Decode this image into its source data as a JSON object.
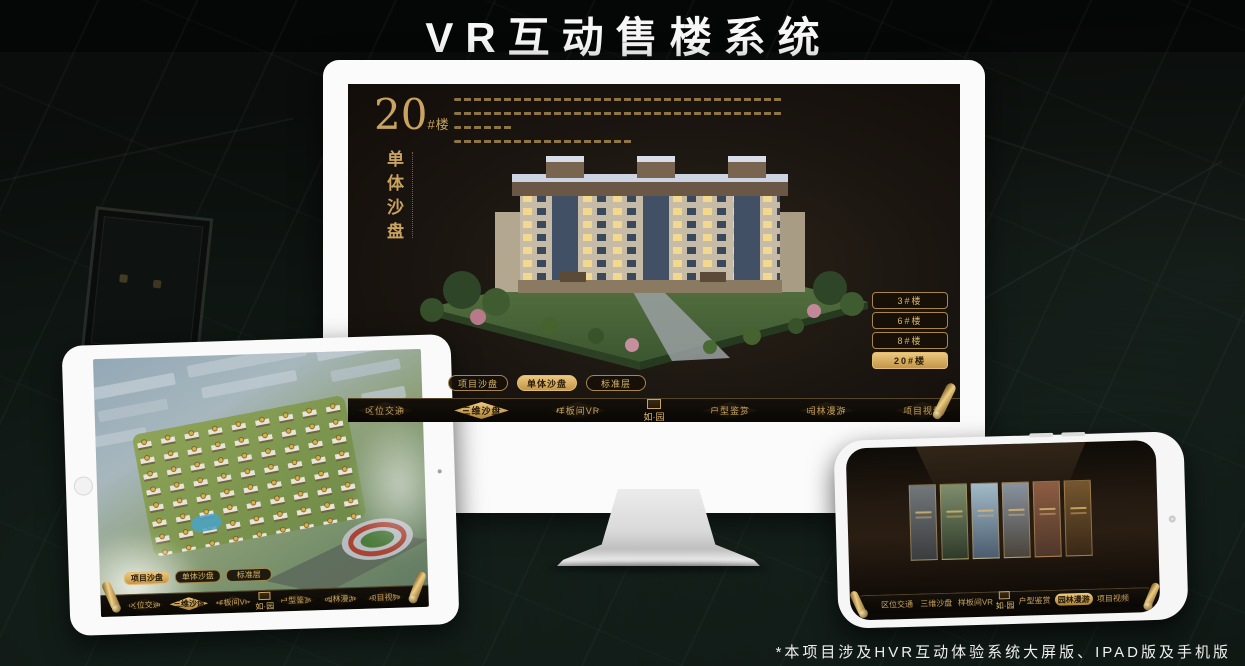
{
  "page": {
    "title": "VR互动售楼系统",
    "footnote": "*本项目涉及HVR互动体验系统大屏版、IPAD版及手机版"
  },
  "ui": {
    "logo": "如·园",
    "tabs": [
      "项目沙盘",
      "单体沙盘",
      "标准层"
    ],
    "nav": [
      "区位交通",
      "三维沙盘",
      "样板间VR",
      "户型鉴赏",
      "园林漫游",
      "项目视频"
    ]
  },
  "monitor": {
    "heading_number": "20",
    "heading_unit": "#楼",
    "heading_subtitle": "单体沙盘",
    "floor_buttons": [
      "3#楼",
      "6#楼",
      "8#楼",
      "20#楼"
    ],
    "active_floor": "20#楼",
    "active_tab": "单体沙盘",
    "active_nav": "三维沙盘"
  },
  "tablet": {
    "active_tab": "项目沙盘",
    "active_nav": "三维沙盘"
  },
  "phone": {
    "active_nav": "园林漫游"
  },
  "colors": {
    "gold": "#c9a35f",
    "gold_bright": "#e6c178",
    "screen_bg": "#17120c",
    "title_text": "#f7f7f7"
  }
}
